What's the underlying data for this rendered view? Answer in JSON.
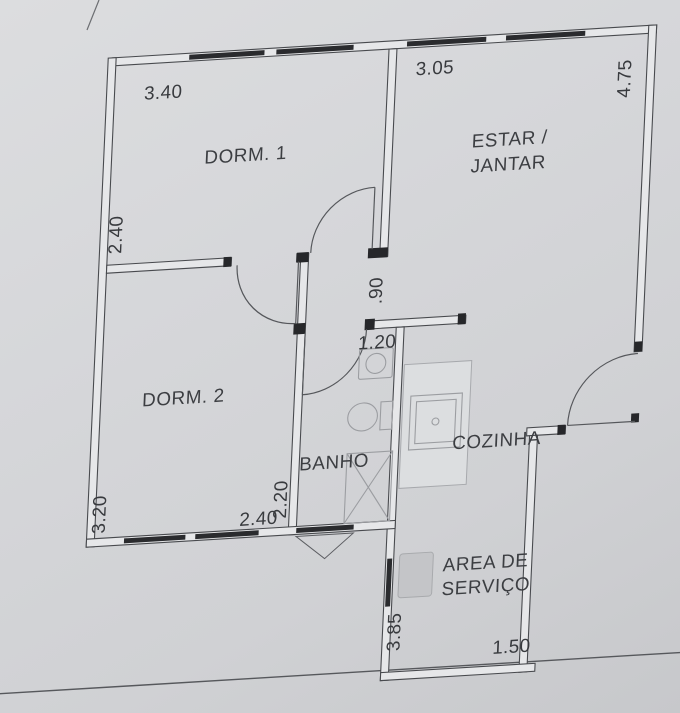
{
  "rooms": {
    "dorm1": {
      "label": "DORM. 1",
      "dim_width": "3.40",
      "dim_height": "2.40"
    },
    "estar": {
      "label_line1": "ESTAR /",
      "label_line2": "JANTAR",
      "dim_width": "3.05",
      "dim_height": "4.75"
    },
    "dorm2": {
      "label": "DORM. 2",
      "dim_height": "3.20",
      "dim_width": "2.40"
    },
    "banho": {
      "label": "BANHO",
      "dim_width": "1.20",
      "dim_height": "2.20"
    },
    "hall": {
      "dim_height": ".90"
    },
    "cozinha": {
      "label": "COZINHA"
    },
    "area_servico": {
      "label_line1": "AREA DE",
      "label_line2": "SERVIÇO",
      "dim_height": "3.85",
      "dim_width": "1.50"
    }
  },
  "colors": {
    "paper": "#d4d5d8",
    "ink": "#46484c",
    "window_bar": "#27282b",
    "text": "#3a3c40"
  }
}
